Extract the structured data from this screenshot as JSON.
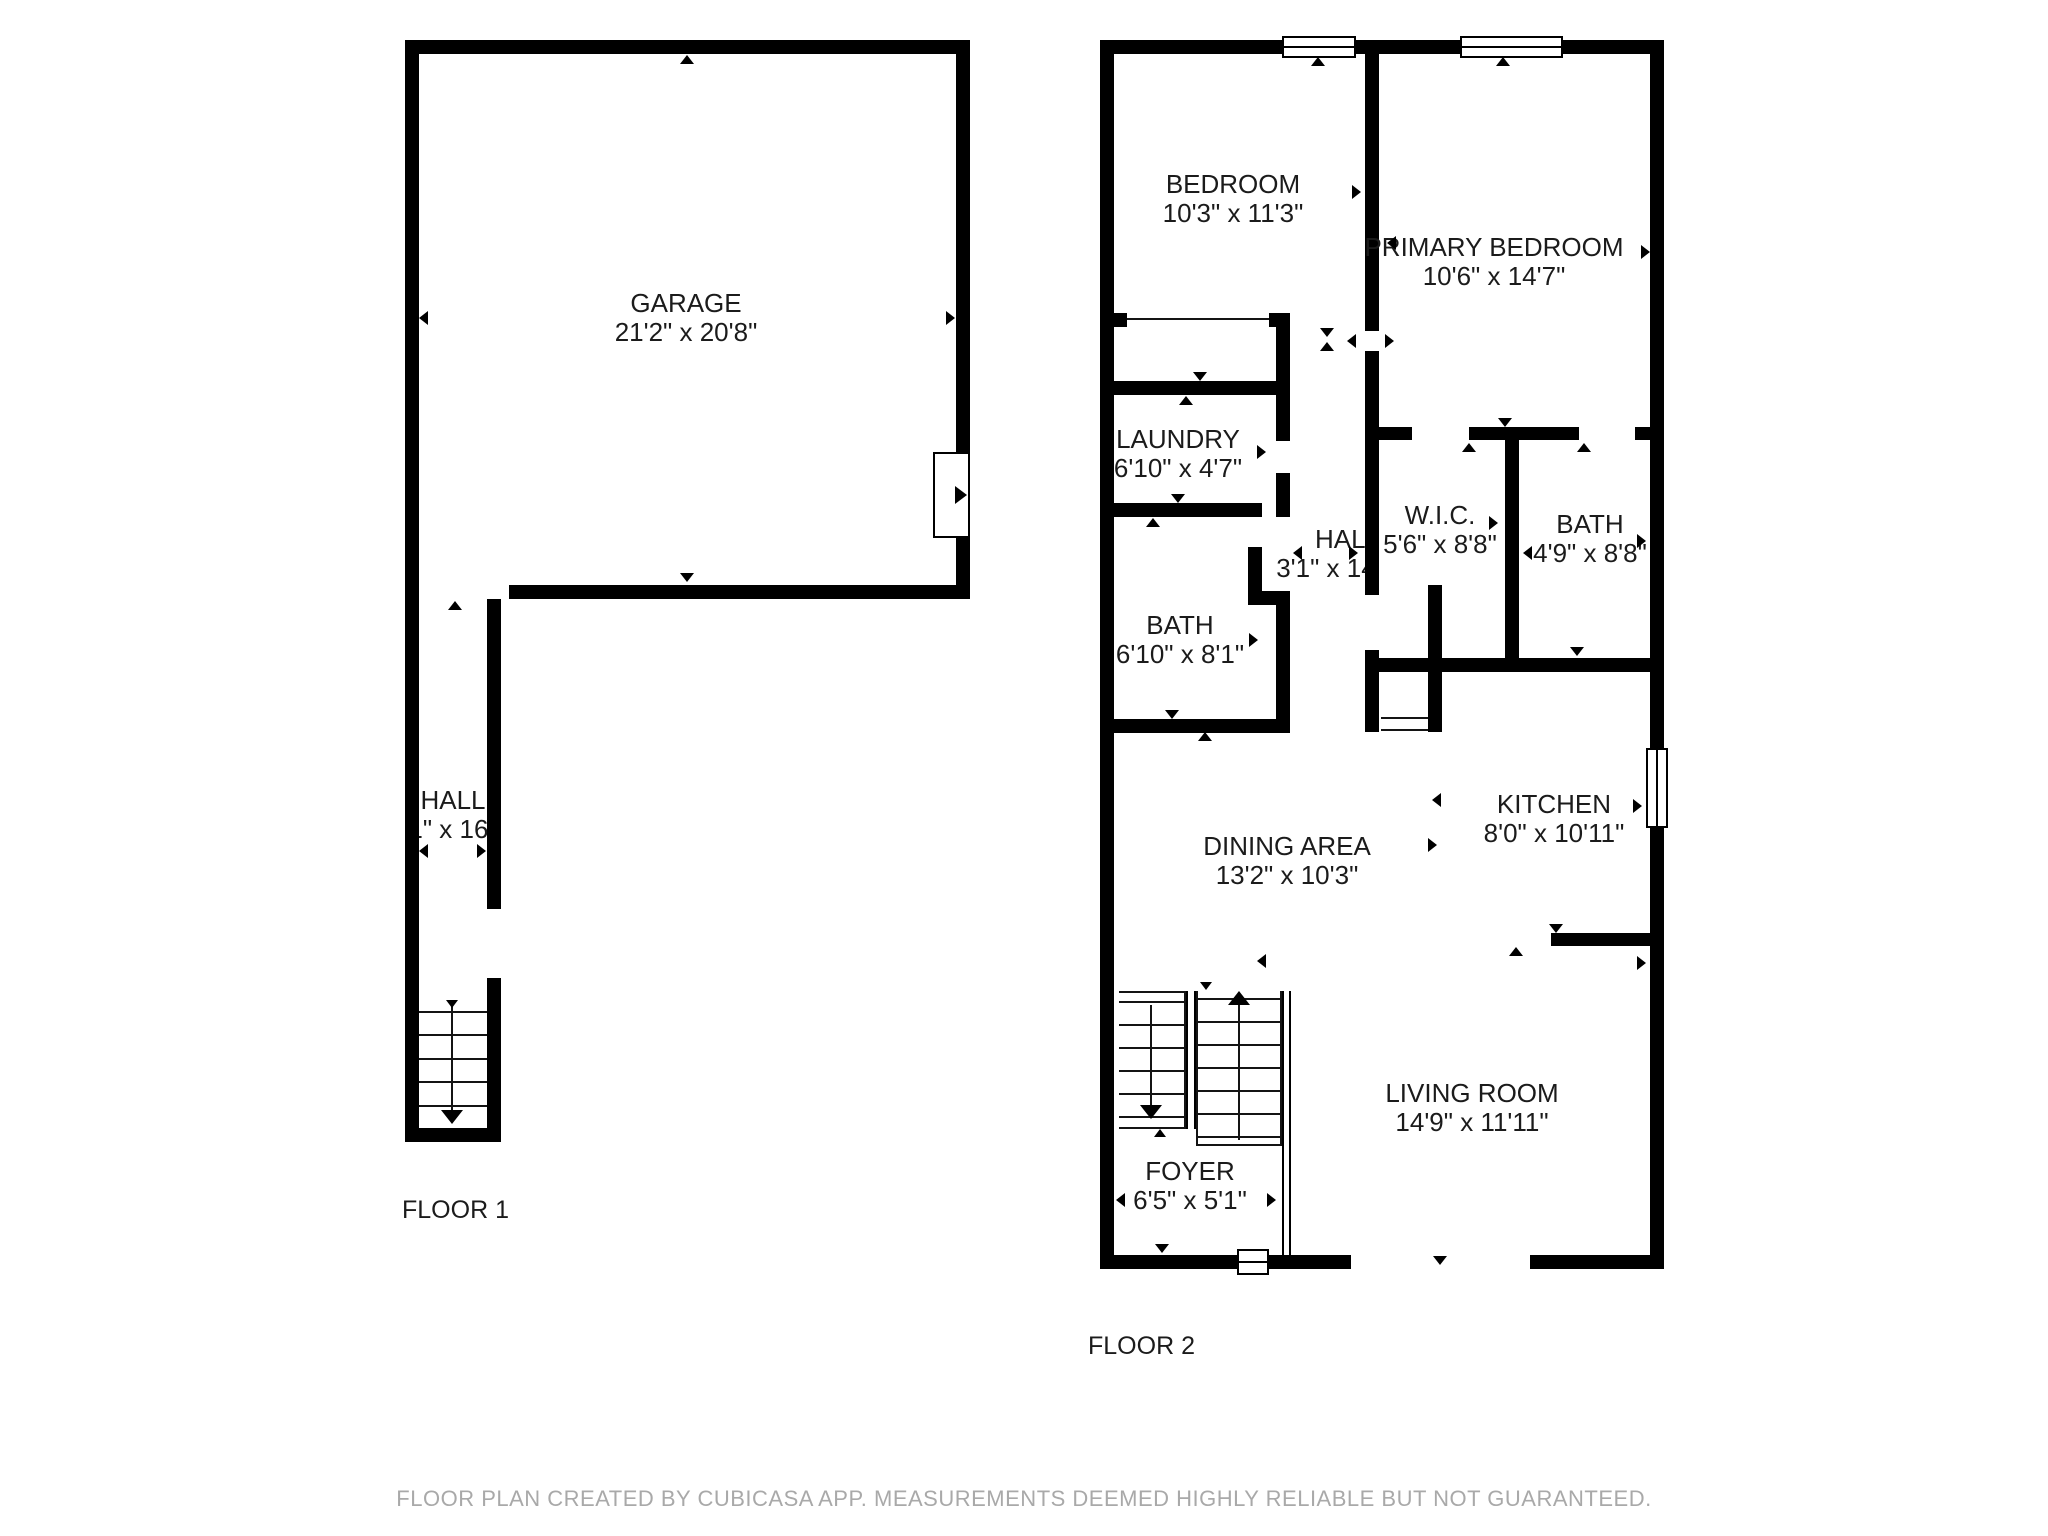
{
  "floors": [
    {
      "label": "FLOOR 1",
      "rooms": [
        {
          "name": "GARAGE",
          "dims": "21'2\" x 20'8\""
        },
        {
          "name": "HALL",
          "dims": "3'1\" x 16'4\""
        }
      ]
    },
    {
      "label": "FLOOR 2",
      "rooms": [
        {
          "name": "BEDROOM",
          "dims": "10'3\" x 11'3\""
        },
        {
          "name": "PRIMARY BEDROOM",
          "dims": "10'6\" x 14'7\""
        },
        {
          "name": "LAUNDRY",
          "dims": "6'10\" x 4'7\""
        },
        {
          "name": "HALL",
          "dims": "3'1\" x 14'10\""
        },
        {
          "name": "W.I.C.",
          "dims": "5'6\" x 8'8\""
        },
        {
          "name": "BATH",
          "dims": "4'9\" x 8'8\""
        },
        {
          "name": "BATH",
          "dims": "6'10\" x 8'1\""
        },
        {
          "name": "DINING AREA",
          "dims": "13'2\" x 10'3\""
        },
        {
          "name": "KITCHEN",
          "dims": "8'0\" x 10'11\""
        },
        {
          "name": "LIVING ROOM",
          "dims": "14'9\" x 11'11\""
        },
        {
          "name": "FOYER",
          "dims": "6'5\" x 5'1\""
        }
      ]
    }
  ],
  "footer": {
    "disclaimer": "FLOOR PLAN CREATED BY CUBICASA APP. MEASUREMENTS DEEMED HIGHLY RELIABLE BUT NOT GUARANTEED."
  },
  "colors": {
    "wall": "#000000",
    "room_text": "#1b1b1b",
    "footer_text": "#a9a9a9",
    "background": "#ffffff"
  }
}
